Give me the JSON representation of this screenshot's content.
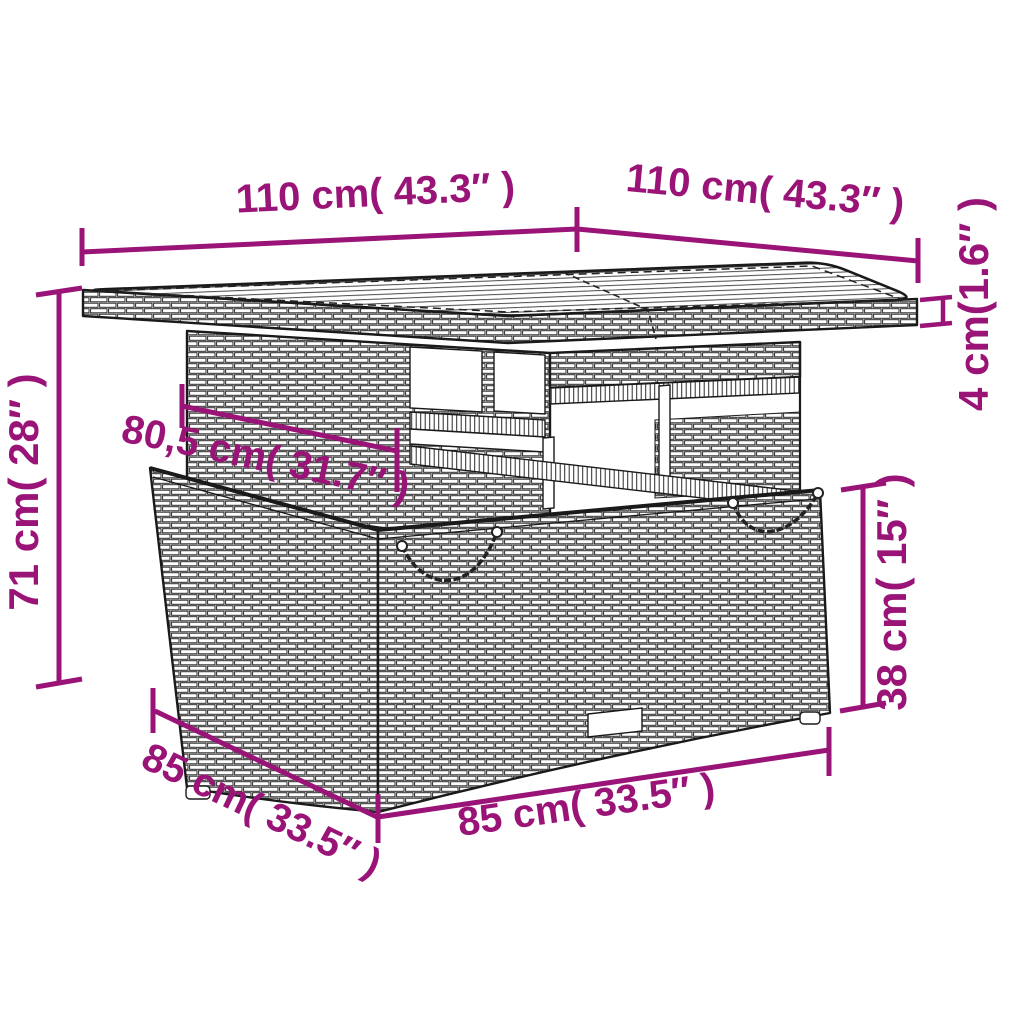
{
  "diagram": {
    "description": "Line-art dimension diagram of a poly rattan garden table with wood-slat top and storage base",
    "background": "#ffffff",
    "line_color": "#1a1a1a",
    "annotation_color": "#9A1478",
    "labels": {
      "top_width": "110 cm( 43.3″ )",
      "top_depth": "110 cm( 43.3″ )",
      "tabletop_thickness": "4 cm(1.6″ )",
      "total_height": "71 cm( 28″ )",
      "understructure_width": "80,5 cm( 31.7″ )",
      "base_height": "38 cm( 15″ )",
      "base_depth": "85 cm( 33.5″ )",
      "base_width": "85 cm( 33.5″ )"
    }
  }
}
